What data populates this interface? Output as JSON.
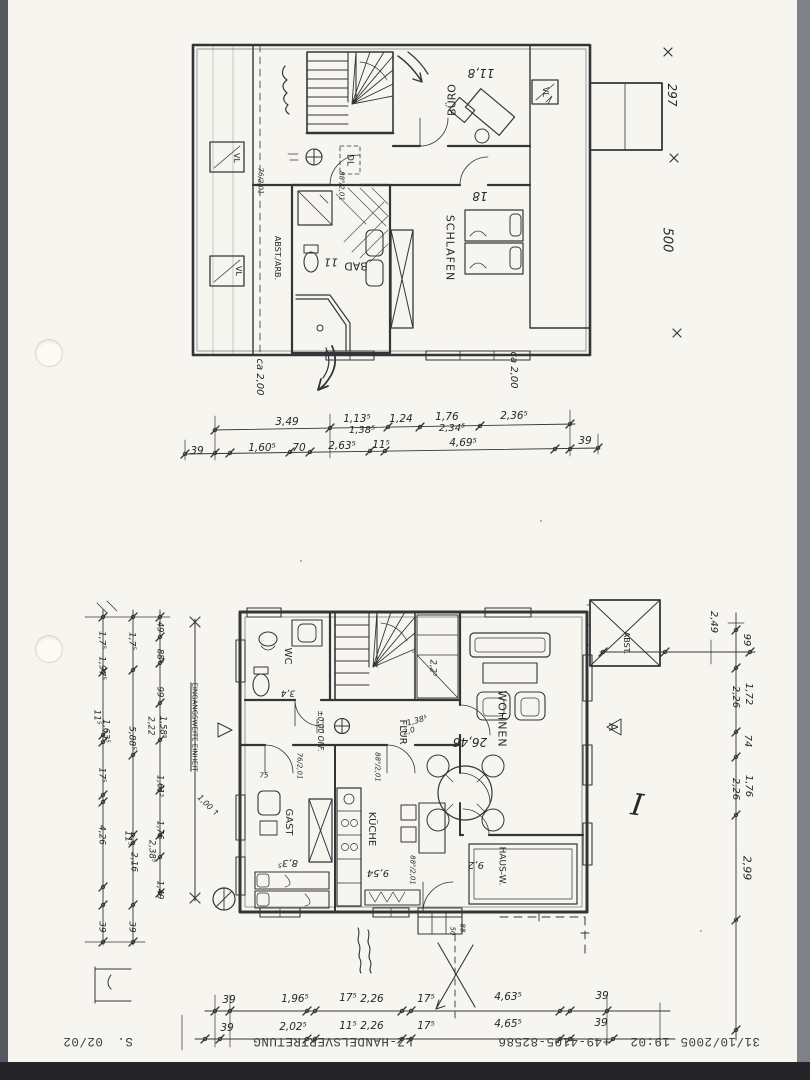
{
  "colors": {
    "ink": "#2b2b30",
    "paper": "#f6f5ef",
    "scanner-bg": "#55585e",
    "scanner-right": "#7e8288",
    "scanner-bottom": "#232528"
  },
  "footer": {
    "date": "31/10/2005",
    "time": "19:02",
    "fax_number": "+49-4105-82586",
    "sender": "LZ-HANDELSVERTRETUNG",
    "page_abbr": "S.",
    "page_number": "02/02"
  },
  "upper": {
    "rooms": {
      "buero": {
        "name": "BÜRO",
        "area": "11,8"
      },
      "schlafen": {
        "name": "SCHLAFEN",
        "area": "18"
      },
      "bad": {
        "name": "BAD",
        "area": "11"
      },
      "abst_arb": {
        "name": "ABST./ARB."
      },
      "diele": {
        "name": "DL"
      }
    },
    "skylight": "VL",
    "side_dims": [
      "297",
      "500"
    ],
    "clearance_left": "ca 2,00",
    "clearance_right": "ca 2,00",
    "door_dims": [
      "76/2,01",
      "88⁵/2,01"
    ],
    "dim_row1": [
      "3,49",
      "1,13⁵",
      "1,24",
      "1,76",
      "2,36⁵"
    ],
    "dim_row1_alt": [
      "1,38⁵",
      "2,34⁵"
    ],
    "dim_row2": [
      "39",
      "1,60⁵",
      "70",
      "2,63⁵",
      "11⁵",
      "4,69⁵",
      "39"
    ]
  },
  "ground": {
    "rooms": {
      "wc": {
        "name": "WC",
        "area": "3,4"
      },
      "flur": {
        "name": "FLUR"
      },
      "wohnen": {
        "name": "WOHNEN",
        "area": "26,46"
      },
      "gast": {
        "name": "GAST",
        "area": "8,3⁵"
      },
      "kueche": {
        "name": "KÜCHE",
        "area": "9,54"
      },
      "hausw": {
        "name": "HAUS-W.",
        "area": "9,2"
      },
      "abst": {
        "name": "ABST."
      }
    },
    "level_note": "±0,00 OFF.",
    "entrance_note": "EINGANGSWEITE EINHEIT",
    "entrance_width": "1,00 ↑",
    "section_marker": "A",
    "sheet_mark": "I",
    "stair_landing_dim": "2,2⁵",
    "passage_dims": [
      "1,38⁵",
      "2,0"
    ],
    "door_dims": [
      "76/2,01",
      "88⁵/2,01",
      "88⁵/2,01"
    ],
    "small_dims": [
      "75",
      "50",
      "88"
    ],
    "left_colA": [
      "1,7⁵",
      "1,97⁵",
      "11⁵",
      "1,63⁵",
      "17⁵",
      "4,26",
      "39"
    ],
    "left_colB": [
      "1,7⁵",
      "5,88⁵",
      "11⁵",
      "2,16",
      "39"
    ],
    "left_colC": [
      "49",
      "88⁵",
      "99",
      "2,22",
      "1,58⁵",
      "1,61⁵",
      "1,76",
      "2,38⁵",
      "1,49"
    ],
    "right_col_top": "2,49",
    "right_col": [
      "99",
      "2,26",
      "1,72",
      "74",
      "2,26",
      "1,76",
      "2,99"
    ],
    "dim_row1": [
      "39",
      "1,96⁵",
      "17⁵",
      "2,26",
      "17⁵",
      "4,63⁵",
      "39"
    ],
    "dim_row2": [
      "39",
      "2,02⁵",
      "11⁵",
      "2,26",
      "17⁵",
      "4,65⁵",
      "39"
    ]
  }
}
